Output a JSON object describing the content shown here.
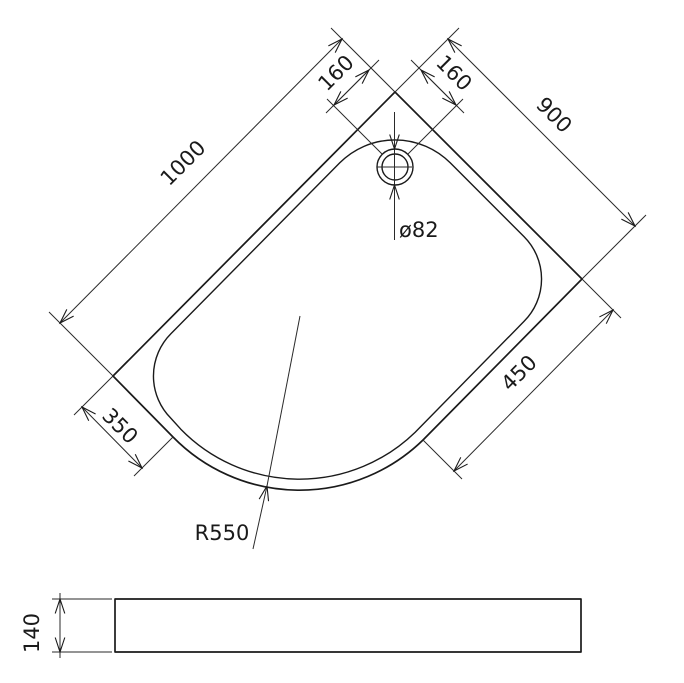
{
  "diagram": {
    "labels": {
      "side_left": "1000",
      "side_right": "900",
      "drain_offset_left": "160",
      "drain_offset_right": "160",
      "drain_diameter": "ø82",
      "rim_right": "450",
      "rim_left": "350",
      "corner_radius": "R550",
      "tray_height": "140"
    },
    "colors": {
      "line": "#1a1a1a",
      "background": "#ffffff"
    }
  }
}
